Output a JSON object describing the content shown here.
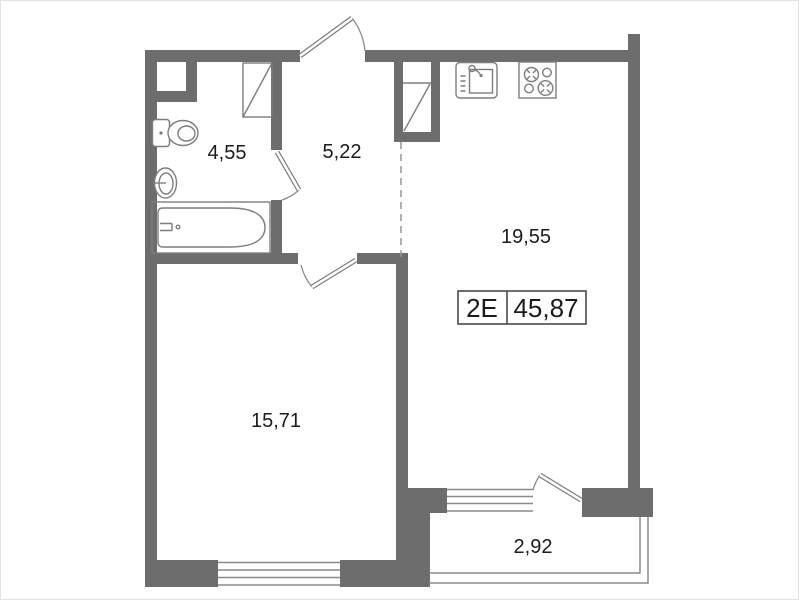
{
  "plan": {
    "unit_type_label": "2E",
    "total_area_label": "45,87",
    "rooms": [
      {
        "id": "bathroom",
        "area_label": "4,55"
      },
      {
        "id": "hallway",
        "area_label": "5,22"
      },
      {
        "id": "kitchen_living",
        "area_label": "19,55"
      },
      {
        "id": "bedroom",
        "area_label": "15,71"
      },
      {
        "id": "balcony",
        "area_label": "2,92"
      }
    ],
    "fixtures": [
      "toilet",
      "washbasin",
      "bathtub",
      "kitchen-sink",
      "stove-4-burner"
    ],
    "colors": {
      "wall": "#6d6d6d",
      "line": "#7d7d7d",
      "text": "#1b1b1b",
      "background": "#ffffff"
    }
  }
}
